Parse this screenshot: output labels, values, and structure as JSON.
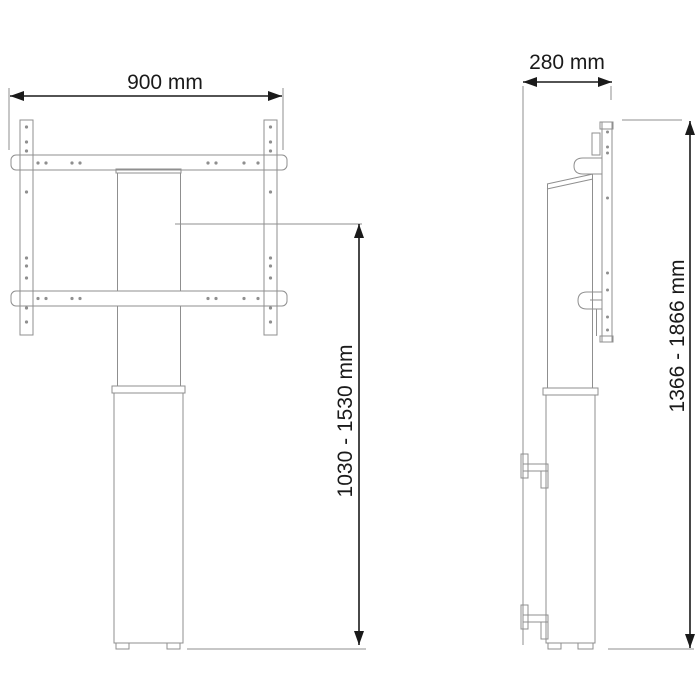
{
  "drawing": {
    "type": "technical-dimension-drawing",
    "views": {
      "front": "front-view",
      "side": "side-view"
    },
    "dimensions": {
      "front_width": "900 mm",
      "side_depth": "280 mm",
      "mount_height_range": "1030 - 1530 mm",
      "total_height_range": "1366 - 1866 mm"
    },
    "colors": {
      "outline": "#8f8f8f",
      "dimension": "#1a1a1a",
      "background": "#ffffff"
    }
  }
}
